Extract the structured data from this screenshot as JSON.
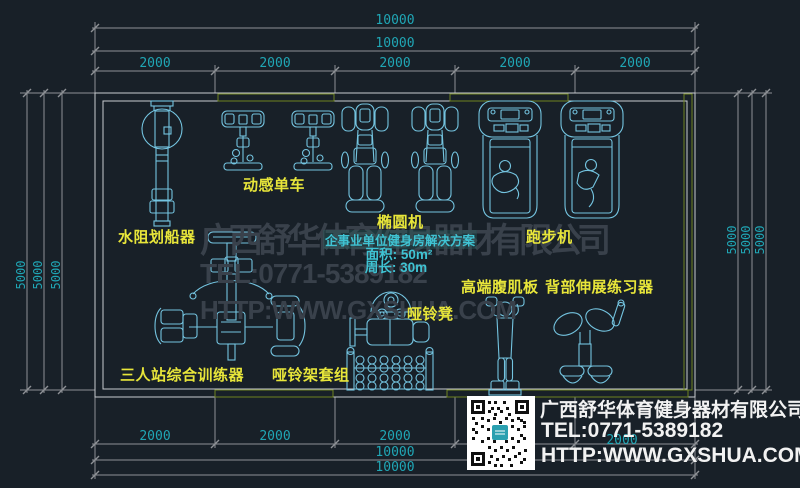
{
  "colors": {
    "background": "#182028",
    "wall_line": "#c9ccd0",
    "wall_highlight": "#a9c73d",
    "dimension_line": "#8e9196",
    "dimension_text": "#20a6b5",
    "equipment_line": "#74c4e0",
    "label_text": "#e8e63a",
    "watermark_text": "#39414b",
    "solution_text": "#3fc3d3",
    "info_text": "#f2f2f2",
    "accent_red": "#c63030"
  },
  "dims": {
    "top_overall": [
      "10000",
      "10000"
    ],
    "top_segments": [
      "2000",
      "2000",
      "2000",
      "2000",
      "2000"
    ],
    "bottom_segments": [
      "2000",
      "2000",
      "2000",
      "2000",
      "2000"
    ],
    "bottom_overall": [
      "10000",
      "10000"
    ],
    "left": [
      "5000",
      "5000",
      "5000"
    ],
    "right": [
      "5000",
      "5000",
      "5000"
    ]
  },
  "equipment_labels": {
    "rower": "水阻划船器",
    "spin_bike": "动感单车",
    "elliptical": "椭圆机",
    "treadmill": "跑步机",
    "ab_board": "高端腹肌板",
    "back_extension": "背部伸展练习器",
    "dumbbell_bench": "哑铃凳",
    "multi_station": "三人站综合训练器",
    "dumbbell_rack": "哑铃架套组"
  },
  "solution_note": {
    "title": "企事业单位健身房解决方案",
    "area_label": "面积: 50m²",
    "perimeter_label": "周长: 30m"
  },
  "watermark": {
    "line1": "广西舒华体育健身器材有限公司",
    "line2": "TEL:0771-5389182",
    "line3": "HTTP:WWW.GXSHUA.COM"
  },
  "info_box": {
    "company": "广西舒华体育健身器材有限公司",
    "tel": "TEL:0771-5389182",
    "website": "HTTP:WWW.GXSHUA.COM"
  }
}
